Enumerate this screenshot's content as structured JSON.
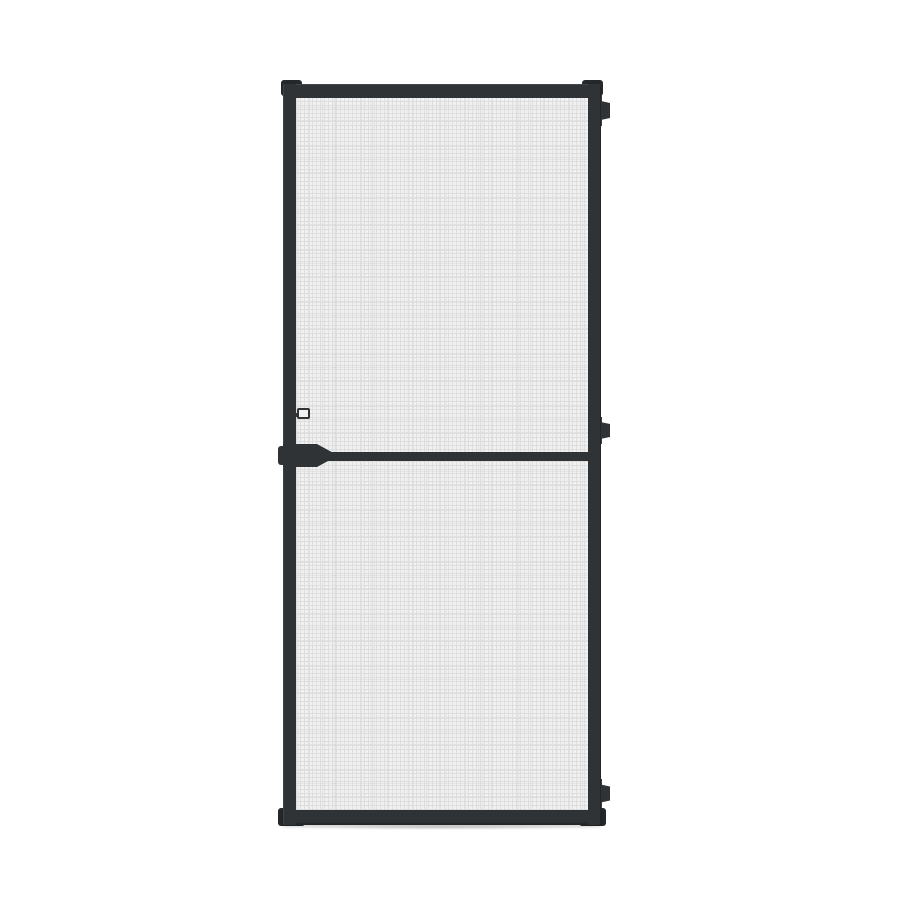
{
  "scene": {
    "description": "Studio product photograph of a hinged insect screen door on a plain white background: dark charcoal aluminium frame, fine grey fibreglass mesh in two panels, a middle crossbar with tapered pull-handle plate and latch keeper on the left stile, and three stepped hinge caps along the right stile.",
    "object": "insect-screen-door",
    "visible_text": ""
  },
  "colors": {
    "background": "#ffffff",
    "frame": "#2f3335",
    "frame-dark": "#24282a",
    "mesh-base": "#f1f1f1",
    "mesh-line": "#dedede",
    "shadow": "rgba(0,0,0,0.16)"
  },
  "parts": {
    "door": "screen door leaf",
    "left_stile": "left frame stile",
    "right_stile": "right frame stile (hinge side)",
    "top_rail": "top frame rail",
    "bottom_rail": "bottom frame rail",
    "mesh_upper": "upper mesh panel",
    "mesh_lower": "lower mesh panel",
    "crossbar": "middle crossbar",
    "handle": "tapered pull-handle plate",
    "handle_boss": "handle boss on outer left edge",
    "latch": "latch keeper tab",
    "hinge_top": "top hinge cap",
    "hinge_middle": "middle hinge cap",
    "hinge_bottom": "bottom hinge cap",
    "corner_caps": [
      "top-left corner cap",
      "top-right corner cap",
      "bottom-left corner cap",
      "bottom-right corner cap"
    ]
  }
}
